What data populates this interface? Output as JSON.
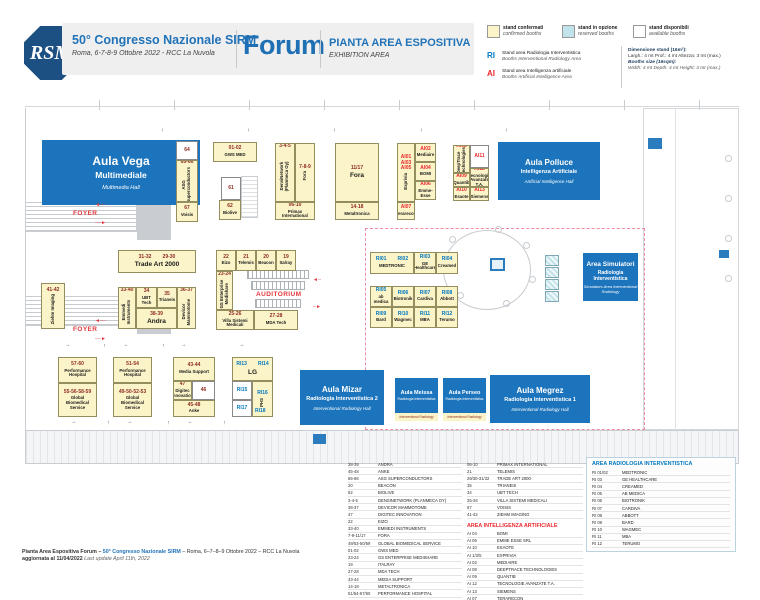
{
  "header": {
    "logo": "RSM",
    "title": "50° Congresso Nazionale SIRM",
    "subtitle": "Roma, 6-7-8-9 Ottobre 2022 - RCC La Nuvola",
    "venue": "Forum",
    "plan_title": "PIANTA AREA ESPOSITIVA",
    "plan_subtitle": "EXHIBITION AREA"
  },
  "legend": {
    "confirmed": {
      "label": "stand confermati",
      "label_en": "confirmed booths",
      "color": "#FBF4C8"
    },
    "reserved": {
      "label": "stand in opzione",
      "label_en": "reserved booths",
      "color": "#C2E3EA"
    },
    "available": {
      "label": "stand disponibili",
      "label_en": "available booths",
      "color": "#FFFFFF"
    },
    "ri": {
      "code": "RI",
      "line1": "Stand area Radiologia Interventistica",
      "line2": "Booths Interventional Radiology Area",
      "color": "#0077C0"
    },
    "ai": {
      "code": "AI",
      "line1": "Stand area Intelligenza artificiale",
      "line2": "Booths Artificial Intelligence Area",
      "color": "#E8282D"
    },
    "dims": {
      "it_title": "Dimensione stand (16m²):",
      "it_body": "Largh.: 4 mt   Prof.: 4 mt   Altezza: 3 mt (max.)",
      "en_title": "Booths size (16sqm):",
      "en_body": "Width: 4 mt   Depth: 4 mt   Height: 3 mt (max.)"
    }
  },
  "plan": {
    "rooms": [
      {
        "id": "vega",
        "name": "Aula Vega",
        "line2": "Multimediale",
        "sub": "Multimedia Hall",
        "size": "xl",
        "x": 17,
        "y": 40,
        "w": 158,
        "h": 65
      },
      {
        "id": "polluce",
        "name": "Aula Polluce",
        "line2": "Intelligenza Artificiale",
        "sub": "Artificial Intelligence Hall",
        "size": "lg2",
        "x": 473,
        "y": 42,
        "w": 102,
        "h": 58
      },
      {
        "id": "simulatori",
        "name": "Area Simulatori",
        "line2": "Radiologia Interventistica",
        "sub": "Simulators Area Interventional Radiology",
        "size": "sm2",
        "x": 558,
        "y": 153,
        "w": 55,
        "h": 48
      },
      {
        "id": "mizar",
        "name": "Aula Mizar",
        "line2": "Radiologia Interventistica 2",
        "sub": "Interventional Radiology Hall",
        "size": "lg2",
        "x": 275,
        "y": 270,
        "w": 84,
        "h": 55
      },
      {
        "id": "meissa",
        "name": "Aula Meissa",
        "line2": "Radiologia Interventistica",
        "strip": "Interventional Radiology",
        "size": "xs",
        "x": 370,
        "y": 278,
        "w": 43,
        "h": 43
      },
      {
        "id": "perseo",
        "name": "Aula Perseo",
        "line2": "Radiologia Interventistica",
        "strip": "Interventional Radiology",
        "size": "xs",
        "x": 418,
        "y": 278,
        "w": 43,
        "h": 43
      },
      {
        "id": "megrez",
        "name": "Aula Megrez",
        "line2": "Radiologia Interventistica 1",
        "sub": "Interventional Radiology Hall",
        "size": "lg2",
        "x": 465,
        "y": 275,
        "w": 100,
        "h": 48
      }
    ],
    "booths": [
      {
        "c": "64",
        "t": "w",
        "x": 151,
        "y": 41,
        "w": 22,
        "h": 19
      },
      {
        "c": "65-66",
        "n": "ASG Superconductors",
        "v": 1,
        "x": 151,
        "y": 60,
        "w": 22,
        "h": 42
      },
      {
        "c": "67",
        "n": "Voisis",
        "x": 151,
        "y": 102,
        "w": 22,
        "h": 20
      },
      {
        "c": "01-02",
        "n": "GWS MED",
        "x": 188,
        "y": 42,
        "w": 44,
        "h": 20
      },
      {
        "c": "61",
        "t": "w",
        "x": 196,
        "y": 77,
        "w": 20,
        "h": 23
      },
      {
        "c": "62",
        "n": "Biolive",
        "x": 194,
        "y": 100,
        "w": 22,
        "h": 20
      },
      {
        "c": "3-4-5",
        "n": "DensiNetwork (Planmeca Oy)",
        "v": 1,
        "x": 250,
        "y": 43,
        "w": 20,
        "h": 59
      },
      {
        "c": "7-8-9",
        "n": "Fora",
        "v": 1,
        "x": 270,
        "y": 43,
        "w": 20,
        "h": 59
      },
      {
        "c": "06-10",
        "n": "Primax International",
        "x": 250,
        "y": 102,
        "w": 40,
        "h": 18
      },
      {
        "c": "11/17",
        "n": "Fora",
        "big": 1,
        "x": 310,
        "y": 43,
        "w": 44,
        "h": 59
      },
      {
        "c": "14-18",
        "n": "Metaltronica",
        "x": 310,
        "y": 102,
        "w": 44,
        "h": 18
      },
      {
        "c": "AI01\nAI03\nAI05",
        "n": "Exprivia",
        "v": 1,
        "cc": "ai",
        "x": 372,
        "y": 43,
        "w": 18,
        "h": 59
      },
      {
        "c": "AI07",
        "n": "Terarecon",
        "cc": "ai",
        "x": 372,
        "y": 102,
        "w": 18,
        "h": 18
      },
      {
        "c": "AI02",
        "n": "Mediaire",
        "cc": "ai",
        "x": 390,
        "y": 43,
        "w": 21,
        "h": 19
      },
      {
        "c": "AI04",
        "n": "BOMI",
        "cc": "ai",
        "x": 390,
        "y": 62,
        "w": 21,
        "h": 19
      },
      {
        "c": "AI06",
        "n": "Emme-Esse",
        "cc": "ai",
        "x": 390,
        "y": 81,
        "w": 21,
        "h": 19
      },
      {
        "c": "AI08",
        "n": "DeepTrace Technologies",
        "v": 1,
        "cc": "ai",
        "x": 428,
        "y": 45,
        "w": 17,
        "h": 28
      },
      {
        "c": "AI09",
        "n": "Quantib",
        "cc": "ai",
        "x": 428,
        "y": 73,
        "w": 17,
        "h": 14
      },
      {
        "c": "AI10",
        "n": "Esaote",
        "cc": "ai",
        "x": 428,
        "y": 87,
        "w": 17,
        "h": 14
      },
      {
        "c": "AI11",
        "t": "w",
        "cc": "ai",
        "x": 445,
        "y": 45,
        "w": 19,
        "h": 23
      },
      {
        "c": "AI12",
        "n": "Tecnologie Avanzate T.A.",
        "cc": "ai",
        "x": 445,
        "y": 68,
        "w": 19,
        "h": 19
      },
      {
        "c": "AI13",
        "n": "Siemens",
        "cc": "ai",
        "x": 445,
        "y": 87,
        "w": 19,
        "h": 14
      },
      {
        "c": "41-42",
        "n": "Ziehm Imaging",
        "v": 1,
        "x": 16,
        "y": 183,
        "w": 24,
        "h": 46
      },
      {
        "c": "31-32        29-30",
        "n": "Trade Art 2000",
        "big": 1,
        "x": 93,
        "y": 150,
        "w": 78,
        "h": 23
      },
      {
        "c": "33-40",
        "n": "Emmedi Instruments",
        "v": 1,
        "x": 93,
        "y": 187,
        "w": 18,
        "h": 42
      },
      {
        "c": "34",
        "n": "UBT Tech",
        "x": 111,
        "y": 187,
        "w": 21,
        "h": 21
      },
      {
        "c": "35",
        "n": "Trianeis",
        "x": 132,
        "y": 187,
        "w": 20,
        "h": 21
      },
      {
        "c": "36-37",
        "n": "Devicor Mammotome",
        "v": 1,
        "x": 152,
        "y": 187,
        "w": 19,
        "h": 42
      },
      {
        "c": "38-39",
        "n": "Andra",
        "big": 1,
        "x": 111,
        "y": 208,
        "w": 41,
        "h": 21
      },
      {
        "c": "22",
        "n": "Eizo",
        "x": 191,
        "y": 150,
        "w": 20,
        "h": 21
      },
      {
        "c": "21",
        "n": "Telemis",
        "x": 211,
        "y": 150,
        "w": 20,
        "h": 21
      },
      {
        "c": "20",
        "n": "Beacon",
        "x": 231,
        "y": 150,
        "w": 20,
        "h": 21
      },
      {
        "c": "19",
        "n": "Italray",
        "x": 251,
        "y": 150,
        "w": 20,
        "h": 21
      },
      {
        "c": "23-24",
        "n": "GS Enterprise Medishare",
        "v": 1,
        "x": 191,
        "y": 171,
        "w": 17,
        "h": 39
      },
      {
        "c": "25-26",
        "n": "Villa Sistemi Medicali",
        "x": 191,
        "y": 210,
        "w": 38,
        "h": 20
      },
      {
        "c": "27-28",
        "n": "MDA Tech",
        "x": 229,
        "y": 210,
        "w": 44,
        "h": 20
      },
      {
        "c": "RI01        RI02",
        "n": "MEDTRONIC",
        "cc": "ri",
        "x": 345,
        "y": 152,
        "w": 44,
        "h": 22
      },
      {
        "c": "RI03",
        "n": "GE Healthcare",
        "cc": "ri",
        "x": 389,
        "y": 152,
        "w": 22,
        "h": 22
      },
      {
        "c": "RI04",
        "n": "Creamed",
        "cc": "ri",
        "x": 411,
        "y": 152,
        "w": 22,
        "h": 22
      },
      {
        "c": "RI05",
        "n": "ab medica",
        "cc": "ri",
        "x": 345,
        "y": 186,
        "w": 22,
        "h": 21
      },
      {
        "c": "RI06",
        "n": "Biotronik",
        "cc": "ri",
        "x": 367,
        "y": 186,
        "w": 22,
        "h": 21
      },
      {
        "c": "RI07",
        "n": "Cardiva",
        "cc": "ri",
        "x": 389,
        "y": 186,
        "w": 22,
        "h": 21
      },
      {
        "c": "RI08",
        "n": "Abbott",
        "cc": "ri",
        "x": 411,
        "y": 186,
        "w": 22,
        "h": 21
      },
      {
        "c": "RI09",
        "n": "Bard",
        "cc": "ri",
        "x": 345,
        "y": 207,
        "w": 22,
        "h": 21
      },
      {
        "c": "RI10",
        "n": "Wagmec",
        "cc": "ri",
        "x": 367,
        "y": 207,
        "w": 22,
        "h": 21
      },
      {
        "c": "RI11",
        "n": "MBA",
        "cc": "ri",
        "x": 389,
        "y": 207,
        "w": 22,
        "h": 21
      },
      {
        "c": "RI12",
        "n": "Terumo",
        "cc": "ri",
        "x": 411,
        "y": 207,
        "w": 22,
        "h": 21
      },
      {
        "c": "57-60",
        "n": "Performance Hospital",
        "x": 33,
        "y": 257,
        "w": 39,
        "h": 26
      },
      {
        "c": "55-56-58-59",
        "n": "Global Biomedical Service",
        "x": 33,
        "y": 283,
        "w": 39,
        "h": 34
      },
      {
        "c": "51-54",
        "n": "Performance Hospital",
        "x": 88,
        "y": 257,
        "w": 39,
        "h": 26
      },
      {
        "c": "49-50-52-53",
        "n": "Global Biomedical Service",
        "x": 88,
        "y": 283,
        "w": 39,
        "h": 34
      },
      {
        "c": "43-44",
        "n": "Media Support",
        "x": 148,
        "y": 257,
        "w": 42,
        "h": 24
      },
      {
        "c": "47",
        "n": "Digitec Innovation",
        "x": 148,
        "y": 281,
        "w": 19,
        "h": 19
      },
      {
        "c": "46",
        "t": "w",
        "x": 167,
        "y": 281,
        "w": 23,
        "h": 19
      },
      {
        "c": "45-48",
        "n": "Anke",
        "x": 148,
        "y": 300,
        "w": 42,
        "h": 17
      },
      {
        "c": "RI13        RI14",
        "n": "LG",
        "big": 1,
        "cc": "ri",
        "x": 207,
        "y": 257,
        "w": 41,
        "h": 24
      },
      {
        "c": "RI15",
        "t": "w",
        "cc": "ri",
        "x": 207,
        "y": 281,
        "w": 20,
        "h": 19
      },
      {
        "c": "RI17",
        "t": "w",
        "cc": "ri",
        "x": 207,
        "y": 300,
        "w": 20,
        "h": 17
      },
      {
        "c": "RI16",
        "n": "PHS",
        "v": 1,
        "cc": "ri",
        "x": 227,
        "y": 281,
        "w": 21,
        "h": 36
      },
      {
        "c": "",
        "t": "r",
        "x": 520,
        "y": 155,
        "w": 14,
        "h": 11
      },
      {
        "c": "",
        "t": "r",
        "x": 520,
        "y": 167,
        "w": 14,
        "h": 11
      },
      {
        "c": "",
        "t": "r",
        "x": 520,
        "y": 179,
        "w": 14,
        "h": 11
      },
      {
        "c": "",
        "t": "r",
        "x": 520,
        "y": 191,
        "w": 14,
        "h": 11
      }
    ],
    "labels": [
      {
        "id": "foyer-label-1",
        "t": "FOYER",
        "cls": "lred",
        "x": 48,
        "y": 110
      },
      {
        "id": "foyer-arrow-left-1",
        "t": "◄╌╌",
        "cls": "lred-s",
        "x": 70,
        "y": 102
      },
      {
        "id": "foyer-arrow-right-1",
        "t": "╌╌►",
        "cls": "lred-s",
        "x": 70,
        "y": 120
      },
      {
        "id": "foyer-label-2",
        "t": "FOYER",
        "cls": "lred",
        "x": 48,
        "y": 226
      },
      {
        "id": "foyer-arrow-left-2",
        "t": "◄╌╌",
        "cls": "lred-s",
        "x": 70,
        "y": 218
      },
      {
        "id": "foyer-arrow-right-2",
        "t": "╌╌►",
        "cls": "lred-s",
        "x": 70,
        "y": 236
      },
      {
        "id": "auditorium-label",
        "t": "AUDITORIUM",
        "cls": "lred",
        "x": 231,
        "y": 191
      },
      {
        "id": "auditorium-arrow-1",
        "t": "◄╌",
        "cls": "lred-s",
        "x": 288,
        "y": 177
      },
      {
        "id": "auditorium-arrow-2",
        "t": "╌►",
        "cls": "lred-s",
        "x": 288,
        "y": 204
      },
      {
        "id": "ri18-code",
        "t": "RI18",
        "cls": "lri",
        "x": 230,
        "y": 308
      },
      {
        "id": "flow-arrow",
        "t": "→",
        "cls": "lk",
        "x": 40,
        "y": 242
      },
      {
        "id": "flow-arrow",
        "t": "↑",
        "cls": "lk",
        "x": 78,
        "y": 243
      },
      {
        "id": "flow-arrow",
        "t": "→",
        "cls": "lk",
        "x": 98,
        "y": 242
      },
      {
        "id": "flow-arrow",
        "t": "↑",
        "cls": "lk",
        "x": 137,
        "y": 243
      },
      {
        "id": "flow-arrow",
        "t": "→",
        "cls": "lk",
        "x": 156,
        "y": 242
      },
      {
        "id": "flow-arrow",
        "t": "→",
        "cls": "lk",
        "x": 214,
        "y": 242
      },
      {
        "id": "flow-arrow",
        "t": "→",
        "cls": "lk",
        "x": 46,
        "y": 319
      },
      {
        "id": "flow-arrow",
        "t": "↑",
        "cls": "lk",
        "x": 82,
        "y": 320
      },
      {
        "id": "flow-arrow",
        "t": "→",
        "cls": "lk",
        "x": 102,
        "y": 319
      },
      {
        "id": "flow-arrow",
        "t": "↑",
        "cls": "lk",
        "x": 142,
        "y": 320
      },
      {
        "id": "flow-arrow",
        "t": "→",
        "cls": "lk",
        "x": 162,
        "y": 319
      },
      {
        "id": "flow-arrow",
        "t": "↑",
        "cls": "lk",
        "x": 198,
        "y": 320
      },
      {
        "id": "flow-arrow",
        "t": "↓",
        "cls": "lk",
        "x": 136,
        "y": 27
      },
      {
        "id": "flow-arrow",
        "t": "↓",
        "cls": "lk",
        "x": 222,
        "y": 27
      },
      {
        "id": "flow-arrow",
        "t": "↓",
        "cls": "lk",
        "x": 308,
        "y": 27
      },
      {
        "id": "flow-arrow",
        "t": "↓",
        "cls": "lk",
        "x": 395,
        "y": 27
      },
      {
        "id": "flow-arrow",
        "t": "↓",
        "cls": "lk",
        "x": 480,
        "y": 27
      }
    ]
  },
  "lists": {
    "col1": [
      {
        "c": "38-39",
        "n": "ANDRA"
      },
      {
        "c": "45-48",
        "n": "ANKE"
      },
      {
        "c": "65-66",
        "n": "ASG SUPERCONDUCTORS"
      },
      {
        "c": "20",
        "n": "BEACON"
      },
      {
        "c": "62",
        "n": "BIOLIVE"
      },
      {
        "c": "3-4-5",
        "n": "DENSINETWORK (PLANMECA OY)"
      },
      {
        "c": "36-37",
        "n": "DEVICOR MAMMOTOME"
      },
      {
        "c": "47",
        "n": "DIGITEC INNOVATION"
      },
      {
        "c": "22",
        "n": "EIZO"
      },
      {
        "c": "33-40",
        "n": "EMMEDI INSTRUMENTS"
      },
      {
        "c": "7-9-11/17",
        "n": "FORA"
      },
      {
        "c": "49/53-50/59",
        "n": "GLOBAL BIOMEDICAL SERVICE"
      },
      {
        "c": "01-02",
        "n": "GWS MED"
      },
      {
        "c": "23-24",
        "n": "GS ENTERPRISE MEDISHARE"
      },
      {
        "c": "19",
        "n": "ITALRAY"
      },
      {
        "c": "27-28",
        "n": "MDA TECH"
      },
      {
        "c": "43-44",
        "n": "MEDIA SUPPORT"
      },
      {
        "c": "14-18",
        "n": "METALTRONICA"
      },
      {
        "c": "51/54-57/60",
        "n": "PERFORMANCE HOSPITAL"
      }
    ],
    "col2": [
      {
        "c": "06-10",
        "n": "PRIMAX INTERNATIONAL"
      },
      {
        "c": "21",
        "n": "TELEMIS"
      },
      {
        "c": "29/30-31/32",
        "n": "TRADE ART 2000"
      },
      {
        "c": "35",
        "n": "TRIANEIS"
      },
      {
        "c": "34",
        "n": "UBT TECH"
      },
      {
        "c": "25-26",
        "n": "VILLA SISTEMI MEDICALI"
      },
      {
        "c": "67",
        "n": "VOISIS"
      },
      {
        "c": "41-42",
        "n": "ZIEHM IMAGING"
      }
    ],
    "ai_heading": "AREA INTELLIGENZA ARTIFICIALE",
    "ai": [
      {
        "c": "AI 04",
        "n": "BOMI"
      },
      {
        "c": "AI 06",
        "n": "EMME ESSE SRL"
      },
      {
        "c": "AI 10",
        "n": "ESAOTE"
      },
      {
        "c": "AI 1/3/5",
        "n": "EXPRIVIA"
      },
      {
        "c": "AI 02",
        "n": "MEDIAIRE"
      },
      {
        "c": "AI 08",
        "n": "DEEPTRACE TECHNOLOGIES"
      },
      {
        "c": "AI 09",
        "n": "QUANTIB"
      },
      {
        "c": "AI 12",
        "n": "TECNOLOGIE AVANZATE T.A."
      },
      {
        "c": "AI 13",
        "n": "SIEMENS"
      },
      {
        "c": "AI 07",
        "n": "TERARECON"
      }
    ],
    "ri_heading": "AREA RADIOLOGIA INTERVENTISTICA",
    "ri": [
      {
        "c": "RI 01/02",
        "n": "MEDTRONIC"
      },
      {
        "c": "RI 03",
        "n": "GE HEALTHCARE"
      },
      {
        "c": "RI 04",
        "n": "CREAMED"
      },
      {
        "c": "RI 05",
        "n": "AB MEDICA"
      },
      {
        "c": "RI 06",
        "n": "BIOTRONIK"
      },
      {
        "c": "RI 07",
        "n": "CARDIVA"
      },
      {
        "c": "RI 08",
        "n": "ABBOTT"
      },
      {
        "c": "RI 09",
        "n": "BARD"
      },
      {
        "c": "RI 10",
        "n": "WAGMEC"
      },
      {
        "c": "RI 11",
        "n": "MBA"
      },
      {
        "c": "RI 12",
        "n": "TERUMO"
      }
    ]
  },
  "footer": {
    "part1": "Pianta Area Espositiva Forum – ",
    "part2": "50° Congresso Nazionale SIRM",
    "part3": " – Roma, 6–7–8–9 Ottobre 2022 – RCC La Nuvola",
    "line2_bold": "aggiornata al 11/04/2022 ",
    "line2_it": "Last update April 11th, 2022"
  }
}
